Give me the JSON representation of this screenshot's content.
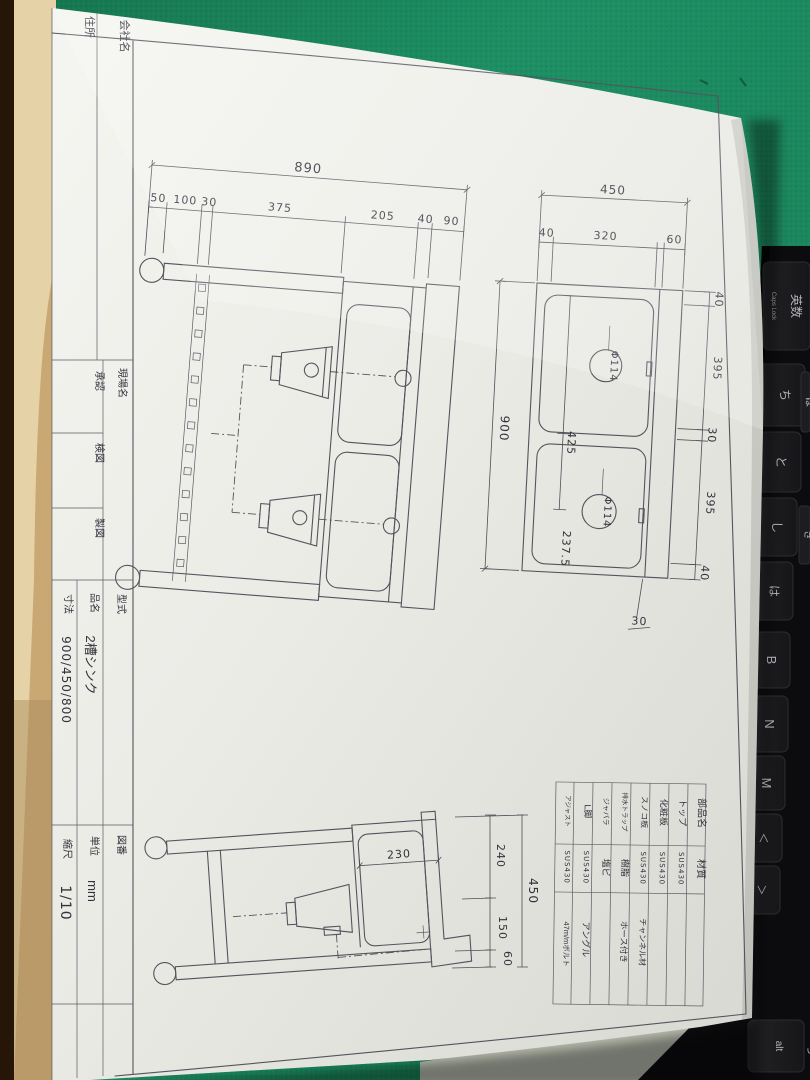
{
  "scene": {
    "mat_color": "#1b8a60",
    "paper_color": "#efefeb",
    "keyboard_color": "#0c0c0e",
    "desk_color": "#b7bcae",
    "table_edge_color": "#d9ba82"
  },
  "title_block": {
    "company_label": "会社名",
    "address_label": "住所",
    "site_label": "現場名",
    "approve_label": "承認",
    "check_label": "検図",
    "draft_label": "製図",
    "model_label": "型式",
    "product_label": "品名",
    "product_value": "2槽シンク",
    "size_label": "寸法",
    "size_value": "900/450/800",
    "drawing_no_label": "図番",
    "unit_label": "単位",
    "unit_value": "mm",
    "scale_label": "縮尺",
    "scale_value": "1/10"
  },
  "parts_table": {
    "part_header": "部品名",
    "material_header": "材質",
    "rows": [
      {
        "part": "トップ",
        "material": "SUS430",
        "note": ""
      },
      {
        "part": "化粧板",
        "material": "SUS430",
        "note": ""
      },
      {
        "part": "スノコ板",
        "material": "SUS430",
        "note": "チャンネル材"
      },
      {
        "part": "排水トラップ",
        "material": "樹脂",
        "note": "ホース付き"
      },
      {
        "part": "ジャバラ",
        "material": "塩ビ",
        "note": ""
      },
      {
        "part": "L脚",
        "material": "SUS430",
        "note": "アングル"
      },
      {
        "part": "アジャスト",
        "material": "SUS430",
        "note": "47m/mボルト"
      }
    ]
  },
  "dims": {
    "front": {
      "overall": "890",
      "c1": "50",
      "c2": "100",
      "c3": "30",
      "c4": "375",
      "c5": "205",
      "c6": "40",
      "c7": "90"
    },
    "plan": {
      "width": "450",
      "w1": "40",
      "w2": "320",
      "w3": "60",
      "height": "900",
      "r1": "40",
      "r2": "395",
      "r3": "30",
      "r4": "395",
      "r5": "40",
      "pitch": "425",
      "half": "237.5",
      "drain1": "Φ114",
      "drain2": "Φ114",
      "gap": "30"
    },
    "side": {
      "depth": "230",
      "r1": "240",
      "r2": "150",
      "r3": "60",
      "overall": "450"
    }
  },
  "keyboard": {
    "keys": [
      {
        "label": "英数",
        "sub": "Caps Lock"
      },
      {
        "label": "ち"
      },
      {
        "label": "と"
      },
      {
        "label": "し"
      },
      {
        "label": "は"
      },
      {
        "label": "B"
      },
      {
        "label": "N"
      },
      {
        "label": "M"
      },
      {
        "label": "＜"
      },
      {
        "label": "＞"
      },
      {
        "label": "alt"
      },
      {
        "label": "ろ"
      },
      {
        "label": "ほ"
      },
      {
        "label": "き"
      }
    ]
  }
}
